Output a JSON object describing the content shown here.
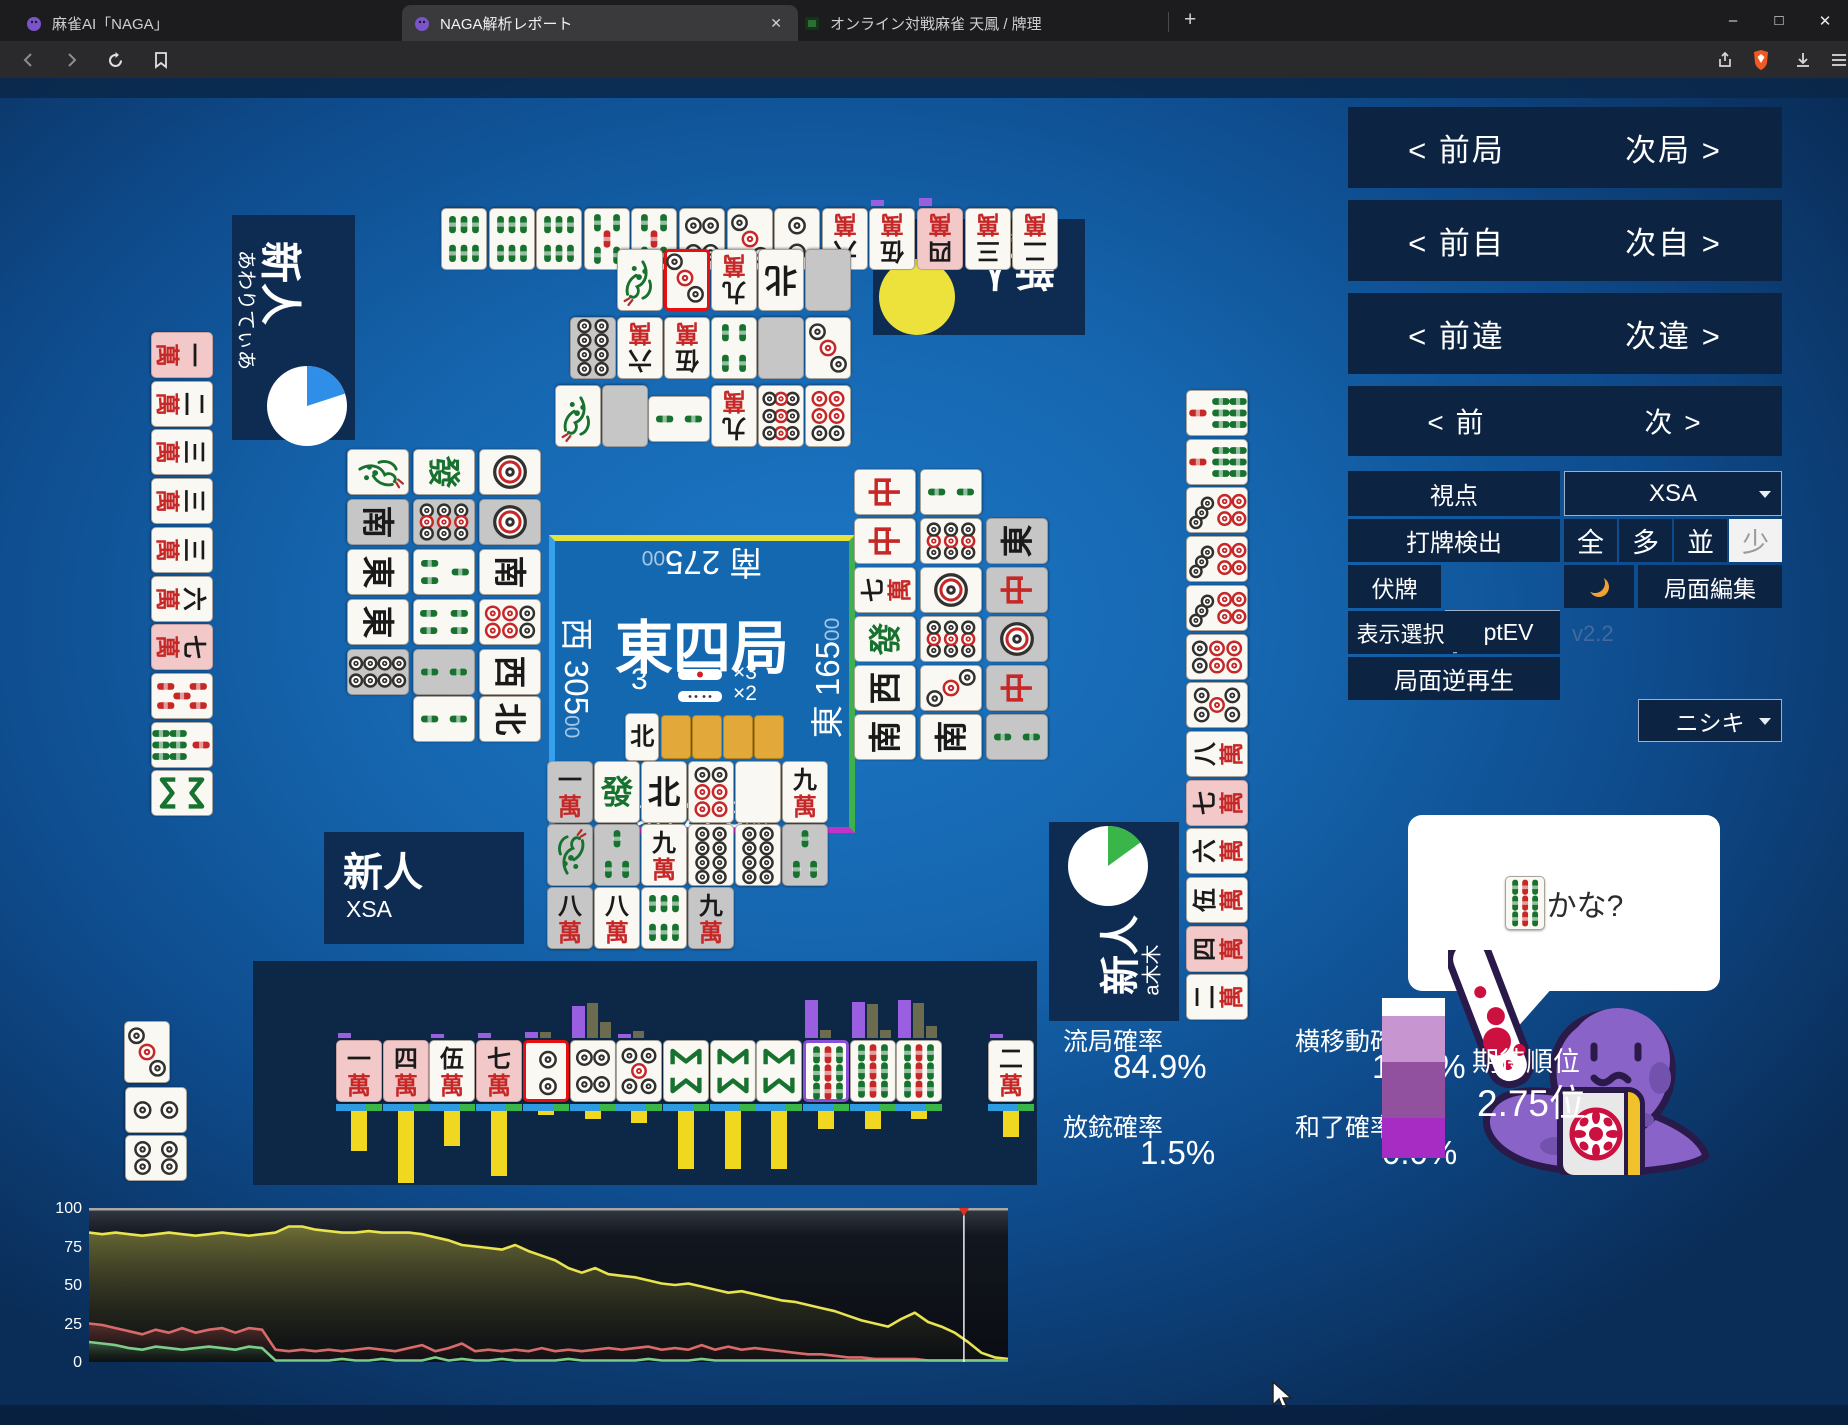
{
  "browser": {
    "tabs": [
      {
        "title": "麻雀AI「NAGA」",
        "active": false
      },
      {
        "title": "NAGA解析レポート",
        "active": true
      },
      {
        "title": "オンライン対戦麻雀 天鳳 / 牌理",
        "active": false
      }
    ],
    "url": "https://naga.dmv.nico/htmls/ec07d201da3116ec1b91aaca8deb685924d348df11ce356436650e13f1bb9e6bv2_2.html?tw=0"
  },
  "nav": {
    "rows": [
      {
        "left": "< 前局",
        "right": "次局 >"
      },
      {
        "left": "< 前自",
        "right": "次自 >"
      },
      {
        "left": "< 前違",
        "right": "次違 >"
      },
      {
        "left": "< 前",
        "right": "次 >"
      }
    ]
  },
  "controls": {
    "viewpoint_label": "視点",
    "viewpoint_value": "XSA",
    "dahai_label": "打牌検出",
    "dahai_options": [
      "全",
      "多",
      "並",
      "少"
    ],
    "dahai_selected": "少",
    "fusehai_label": "伏牌",
    "fusehai_value": "なし",
    "kyokumen_edit": "局面編集",
    "display_label": "表示選択",
    "display_value": "ptEV",
    "version": "v2.2",
    "model_value": "ニシキ",
    "reverse_play": "局面逆再生"
  },
  "players": {
    "bottom": {
      "rank": "新人",
      "name": "XSA"
    },
    "left": {
      "rank": "新人",
      "name": "あわりてぃあ",
      "pie": {
        "color": "#2f8fe8",
        "fraction": 0.2
      }
    },
    "top": {
      "rank": "新人",
      "name": "一路打西風",
      "pie": {
        "color": "#ede23c",
        "fraction": 1.0
      }
    },
    "right": {
      "rank": "新人",
      "name": "a木木",
      "pie": {
        "color": "#3ab54a",
        "fraction": 0.15
      }
    }
  },
  "center": {
    "round": "東四局",
    "honba": "3",
    "stick1000_count": "×3",
    "stick100_count": "×2",
    "scores": {
      "top": {
        "wind": "南",
        "value": "275",
        "suffix": "00"
      },
      "left": {
        "wind": "西",
        "value": "305",
        "suffix": "00"
      },
      "right": {
        "wind": "東",
        "value": "165",
        "suffix": "00"
      },
      "bottom": {
        "wind": "北",
        "value": "225",
        "suffix": "00"
      }
    },
    "dora_indicators": [
      "N",
      "back",
      "back",
      "back",
      "back"
    ]
  },
  "board": {
    "top_hand": [
      "6s",
      "6s",
      "6s",
      "5s",
      "5s",
      "4p",
      "3p",
      "2p",
      "6m",
      "5m",
      {
        "c": "4m",
        "bg": "p"
      },
      "3m",
      "2m"
    ],
    "top_hand_nubs": [
      0,
      0,
      0,
      0,
      0,
      0,
      0,
      0,
      0,
      6,
      8,
      0,
      0
    ],
    "left_hand": [
      {
        "c": "1m",
        "bg": "p"
      },
      "2m",
      "3m",
      "3m",
      "3m",
      "6m",
      {
        "c": "7m",
        "bg": "p"
      },
      "5sr",
      "7s",
      "8s"
    ],
    "right_hand": [
      "7s",
      "7s",
      "7p",
      "7p",
      "7p",
      "6p",
      "5p",
      "8m",
      {
        "c": "7m",
        "bg": "p"
      },
      "6m",
      "5m",
      {
        "c": "4m",
        "bg": "p"
      },
      "2m"
    ],
    "bottom_hand": {
      "tiles": [
        {
          "c": "1m",
          "bg": "p"
        },
        {
          "c": "4m",
          "bg": "p"
        },
        "5m",
        {
          "c": "7m",
          "bg": "p"
        },
        {
          "c": "2p",
          "b": "red"
        },
        "4p",
        "5p",
        "8s",
        "8s",
        "8s",
        {
          "c": "9s",
          "b": "purple"
        },
        "9s",
        "9s"
      ],
      "draw": "2m",
      "bars": {
        "above_purple": [
          5,
          0,
          4,
          5,
          6,
          32,
          4,
          0,
          0,
          0,
          38,
          36,
          38,
          4
        ],
        "above_olive": [
          [],
          [],
          [],
          [],
          [
            6
          ],
          [
            35,
            16
          ],
          [
            7
          ],
          [],
          [],
          [],
          [
            8
          ],
          [
            34,
            8
          ],
          [
            35,
            12
          ],
          []
        ],
        "below_yellow": [
          40,
          72,
          35,
          65,
          4,
          8,
          12,
          58,
          58,
          58,
          18,
          18,
          8,
          26
        ]
      }
    },
    "left_meld": [
      {
        "c": "3p"
      },
      {
        "c": "2p",
        "rot": true
      },
      {
        "c": "4p",
        "rot": true
      }
    ],
    "discards": {
      "top": [
        [
          "1s",
          {
            "c": "3p",
            "b": "red"
          },
          "9m",
          "N",
          {
            "c": "H",
            "bg": "g"
          }
        ],
        [
          {
            "c": "8p",
            "bg": "g"
          },
          "6m",
          "5m",
          "4s",
          {
            "c": "H",
            "bg": "g"
          },
          "3p"
        ],
        [
          "1s",
          {
            "c": "H",
            "bg": "g"
          },
          {
            "c": "2s",
            "rot": true
          },
          "9m",
          "9p",
          "6p"
        ]
      ],
      "left": [
        [
          "1s",
          "F",
          "1p"
        ],
        [
          {
            "c": "S",
            "bg": "g"
          },
          {
            "c": "9p",
            "bg": "g"
          },
          {
            "c": "1p",
            "bg": "g"
          }
        ],
        [
          "E",
          "3s",
          "S"
        ],
        [
          "E",
          "4s",
          "6p"
        ],
        [
          {
            "c": "8p",
            "bg": "g"
          },
          {
            "c": "2s",
            "bg": "g"
          },
          "W"
        ],
        [
          null,
          "2s",
          "N"
        ]
      ],
      "right": [
        [
          "C",
          "2s",
          null
        ],
        [
          "C",
          "9p",
          {
            "c": "E",
            "bg": "g"
          }
        ],
        [
          "7m",
          "1p",
          {
            "c": "C",
            "bg": "g"
          }
        ],
        [
          "F",
          "9p",
          {
            "c": "1p",
            "bg": "g"
          }
        ],
        [
          "W",
          "3p",
          {
            "c": "C",
            "bg": "g"
          }
        ],
        [
          "S",
          "S",
          {
            "c": "2s",
            "bg": "g"
          }
        ]
      ],
      "bottom": [
        [
          {
            "c": "1m",
            "bg": "g"
          },
          "F",
          "N",
          "6p",
          "H",
          "9m"
        ],
        [
          {
            "c": "1s",
            "bg": "g"
          },
          {
            "c": "3s",
            "bg": "g"
          },
          "9m",
          "8p",
          "8p",
          {
            "c": "3s",
            "bg": "g"
          }
        ],
        [
          {
            "c": "8m",
            "bg": "g"
          },
          "8m",
          "6s",
          {
            "c": "9m",
            "bg": "g"
          }
        ]
      ]
    }
  },
  "bubble": {
    "tile": "9s",
    "text": "かな?"
  },
  "stats": {
    "items": [
      {
        "label": "流局確率",
        "value": "84.9%"
      },
      {
        "label": "横移動確率",
        "value": "13.4%"
      },
      {
        "label": "放銃確率",
        "value": "1.5%"
      },
      {
        "label": "和了確率",
        "value": "0.0%"
      }
    ],
    "rank_label": "期待順位",
    "rank_value": "2.75位",
    "rank_segments": [
      {
        "color": "#ffffff",
        "frac": 0.11
      },
      {
        "color": "#c795cf",
        "frac": 0.29
      },
      {
        "color": "#92519e",
        "frac": 0.35
      },
      {
        "color": "#a62cc4",
        "frac": 0.25
      }
    ]
  },
  "chart_data": {
    "type": "line",
    "title": "",
    "xlabel": "",
    "ylabel": "",
    "ylim": [
      0,
      100
    ],
    "yticks": [
      100,
      75,
      50,
      25,
      0
    ],
    "grid": false,
    "legend": "none",
    "cursor_fraction": 0.952,
    "series": [
      {
        "name": "yellow",
        "color": "#e8e34f",
        "values": [
          84,
          83,
          84,
          83,
          82,
          83,
          84,
          83,
          82,
          83,
          84,
          83,
          82,
          83,
          84,
          88,
          88,
          86,
          85,
          84,
          84,
          85,
          84,
          84,
          84,
          83,
          81,
          79,
          76,
          75,
          74,
          73,
          76,
          72,
          69,
          66,
          61,
          58,
          61,
          57,
          56,
          55,
          53,
          51,
          50,
          51,
          49,
          47,
          45,
          46,
          44,
          42,
          40,
          39,
          37,
          35,
          33,
          30,
          27,
          25,
          23,
          28,
          32,
          26,
          23,
          19,
          13,
          6,
          3,
          2
        ]
      },
      {
        "name": "red",
        "color": "#d96a6a",
        "values": [
          25,
          24,
          22,
          20,
          18,
          21,
          19,
          22,
          19,
          21,
          22,
          19,
          22,
          21,
          8,
          7,
          8,
          7,
          8,
          7,
          8,
          9,
          8,
          7,
          9,
          11,
          7,
          9,
          12,
          7,
          8,
          7,
          8,
          7,
          9,
          7,
          8,
          7,
          8,
          9,
          8,
          9,
          10,
          8,
          9,
          8,
          11,
          8,
          10,
          8,
          9,
          8,
          7,
          6,
          5,
          5,
          4,
          3,
          3,
          2,
          2,
          2,
          2,
          1,
          1,
          1,
          1,
          1,
          1,
          1
        ]
      },
      {
        "name": "green",
        "color": "#7ecc8a",
        "values": [
          13,
          12,
          11,
          9,
          8,
          10,
          9,
          8,
          9,
          10,
          9,
          8,
          10,
          9,
          1,
          1,
          1,
          1,
          1,
          2,
          1,
          1,
          2,
          1,
          1,
          1,
          3,
          1,
          2,
          1,
          1,
          2,
          1,
          1,
          1,
          1,
          2,
          1,
          1,
          1,
          1,
          1,
          2,
          1,
          1,
          1,
          2,
          1,
          1,
          1,
          1,
          1,
          1,
          1,
          1,
          1,
          1,
          1,
          1,
          1,
          1,
          1,
          1,
          1,
          1,
          1,
          1,
          1,
          1,
          1
        ]
      }
    ]
  }
}
